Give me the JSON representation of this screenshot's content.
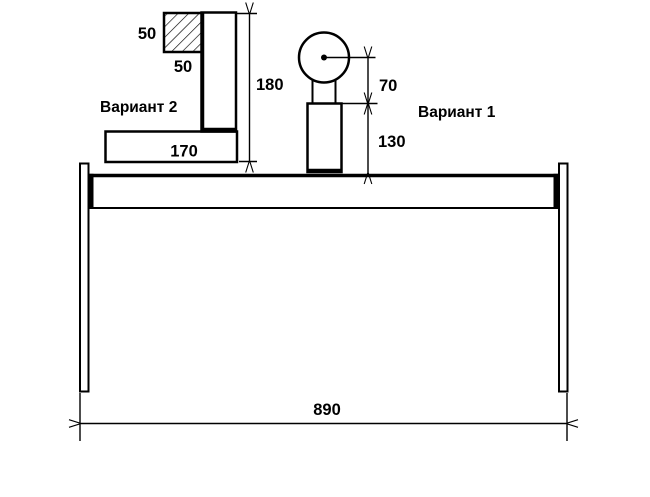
{
  "drawing": {
    "variant2": {
      "label": "Вариант 2",
      "square_height": "50",
      "square_width": "50",
      "total_height": "180",
      "base_width": "170"
    },
    "variant1": {
      "label": "Вариант 1",
      "ball_center_offset": "70",
      "post_height": "130"
    },
    "frame": {
      "span": "890"
    },
    "colors": {
      "line": "#000000",
      "background": "#ffffff"
    }
  }
}
